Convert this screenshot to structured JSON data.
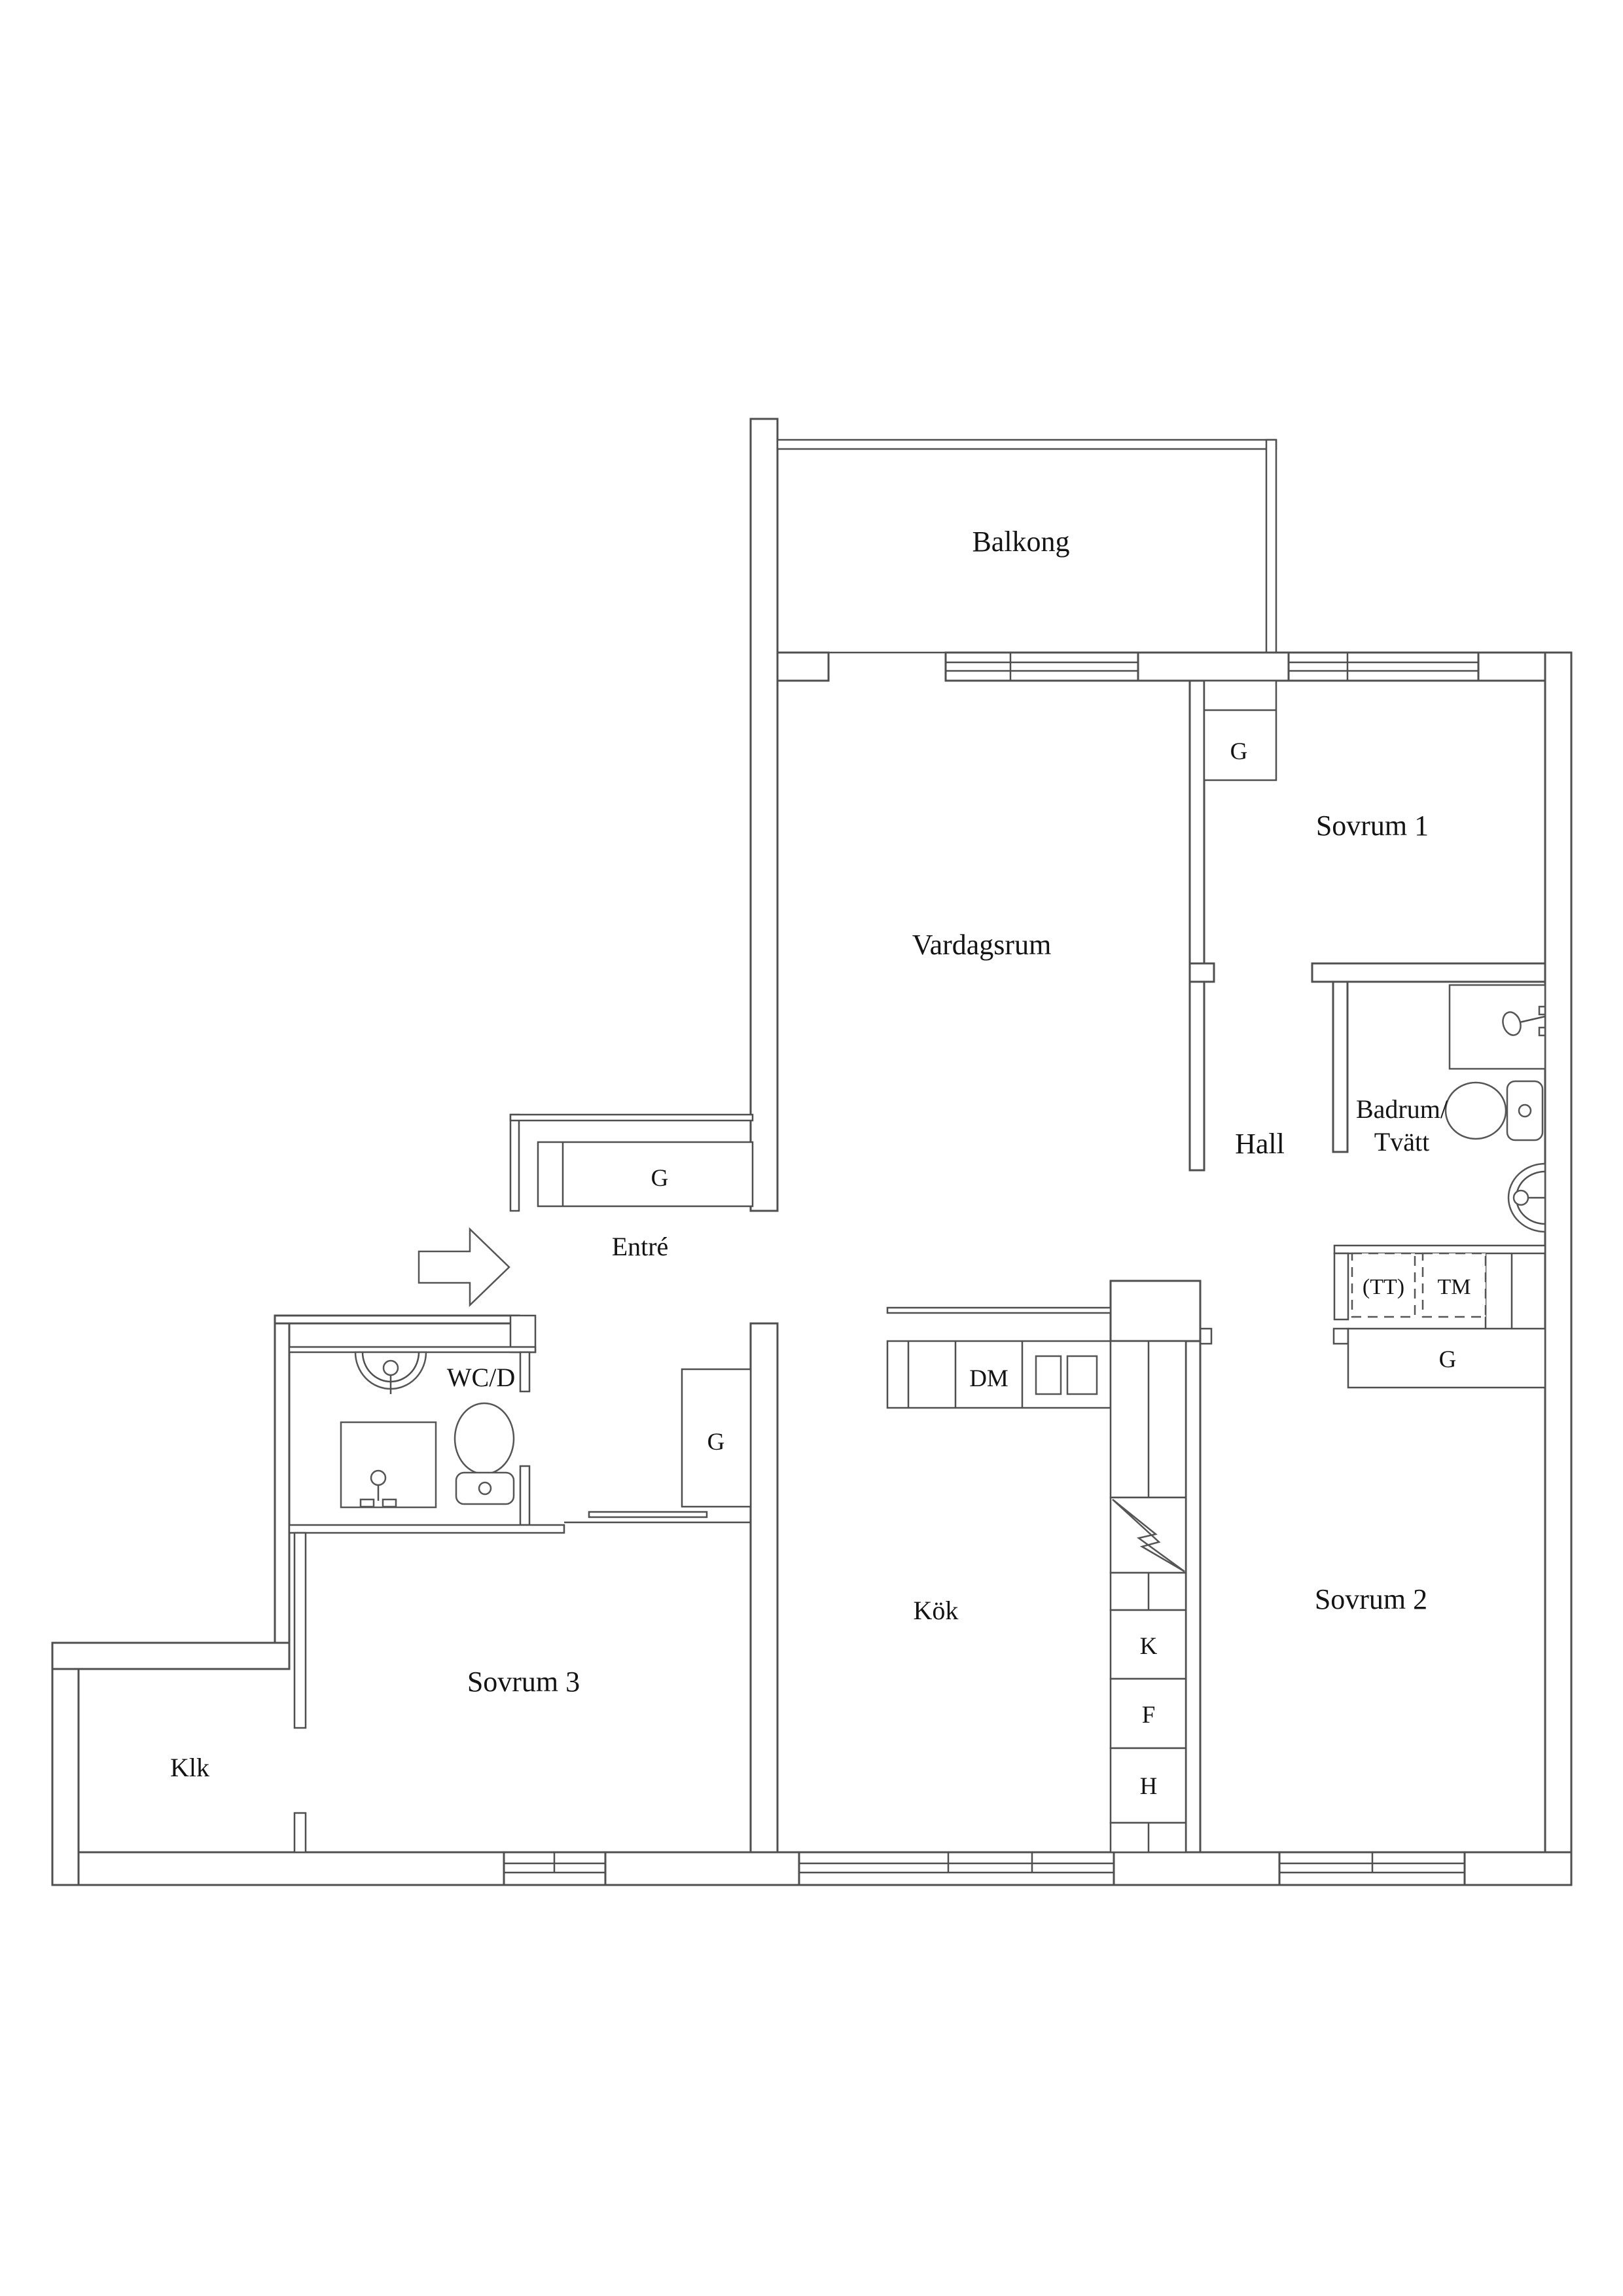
{
  "page": {
    "background_color": "#ffffff",
    "line_color": "#4f4f4f",
    "text_color": "#141414",
    "type": "apartment-floor-plan"
  },
  "labels": {
    "balkong": "Balkong",
    "vardagsrum": "Vardagsrum",
    "sovrum1": "Sovrum 1",
    "hall": "Hall",
    "badrum_line1": "Badrum/",
    "badrum_line2": "Tvätt",
    "entre": "Entré",
    "wcd": "WC/D",
    "kok": "Kök",
    "sovrum2": "Sovrum 2",
    "sovrum3": "Sovrum 3",
    "klk": "Klk",
    "wardrobe": "G",
    "dishwasher": "DM",
    "dryer": "(TT)",
    "washer": "TM",
    "fridge": "K",
    "freezer": "F",
    "tall_cabinet": "H"
  }
}
